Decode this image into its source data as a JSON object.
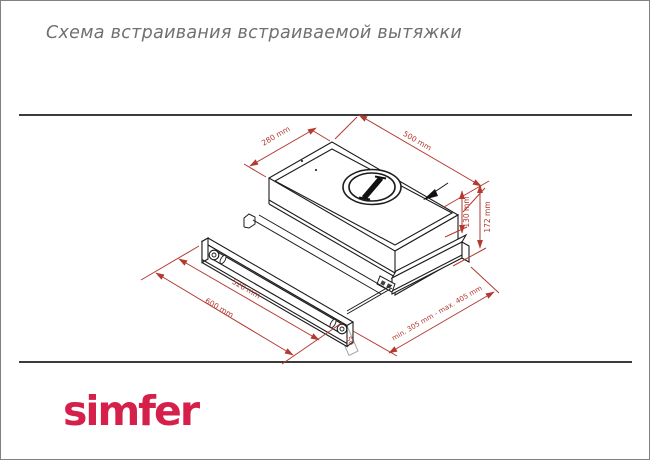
{
  "header": {
    "title": "Схема встраивания встраиваемой вытяжки"
  },
  "footer": {
    "brand": "simfer"
  },
  "diagram": {
    "labels": {
      "depth_top": "280 mm",
      "width_top": "500 mm",
      "height_body": "130 mm",
      "height_total": "172 mm",
      "width_inner": "520 mm",
      "width_front": "600 mm",
      "depth_range": "min. 305 mm - max. 405 mm",
      "front_lip": "50"
    },
    "colors": {
      "dimension_red": "#b23a30",
      "outline_black": "#1c1c1c",
      "brand_red": "#d4204a",
      "rule_gray": "#3b3b3b"
    }
  }
}
